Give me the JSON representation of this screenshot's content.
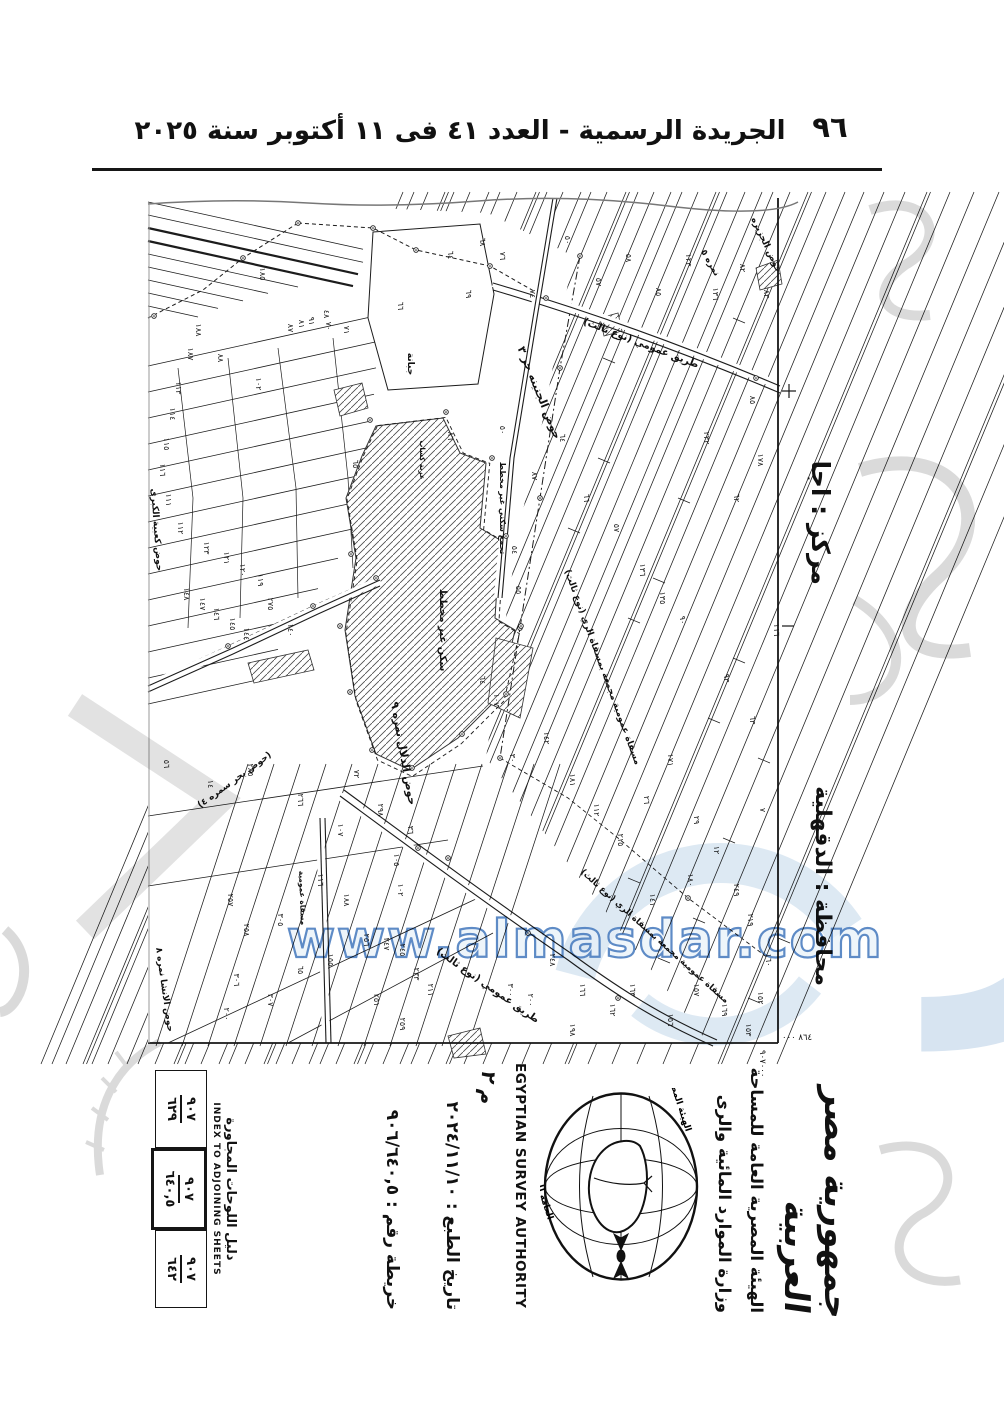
{
  "header": {
    "page_number": "٩٦",
    "title": "الجريدة الرسمية - العدد ٤١ فى ١١ أكتوبر سنة ٢٠٢٥"
  },
  "map": {
    "markaz_label": "مركز : اجا",
    "governorate_label": "محافظة : الدقهلية",
    "easting": "٨٦٤ ٠٠٠",
    "northing": "٩٠٧٠٠٠",
    "area_labels": [
      {
        "t": "حوض الجزيره",
        "x": 616,
        "y": 48,
        "r": 65,
        "s": 9
      },
      {
        "t": "نمره ٥",
        "x": 560,
        "y": 66,
        "r": 60,
        "s": 9
      },
      {
        "t": "طريق عمومي (نوع ثالث)",
        "x": 492,
        "y": 148,
        "r": 21,
        "s": 10
      },
      {
        "t": "حوض الجنينه حر ٣",
        "x": 388,
        "y": 196,
        "r": 68,
        "s": 11
      },
      {
        "t": "مسقاة عمومية مجمعة بمسقاة الري (نوع ثالث)",
        "x": 452,
        "y": 470,
        "r": 70,
        "s": 9
      },
      {
        "t": "حوض الدلال نمره ٩",
        "x": 252,
        "y": 556,
        "r": 80,
        "s": 11
      },
      {
        "t": "(حوض بحر سمره ٤)",
        "x": 88,
        "y": 584,
        "r": -36,
        "s": 9
      },
      {
        "t": "حوض كعبية الكبرى",
        "x": 6,
        "y": 332,
        "r": 86,
        "s": 9
      },
      {
        "t": "حوض الانشا نمره ٨",
        "x": 14,
        "y": 792,
        "r": 82,
        "s": 9
      },
      {
        "t": "جبانة",
        "x": 260,
        "y": 166,
        "r": 90,
        "s": 9
      },
      {
        "t": "سكن غير مخطط",
        "x": 292,
        "y": 432,
        "r": 90,
        "s": 10
      },
      {
        "t": "تجمع سكني غير مخطط",
        "x": 352,
        "y": 310,
        "r": 90,
        "s": 8
      },
      {
        "t": "عزبة كساب",
        "x": 272,
        "y": 262,
        "r": 90,
        "s": 7
      },
      {
        "t": "طريق عمومي (نوع ثالث)",
        "x": 338,
        "y": 790,
        "r": 35,
        "s": 10
      },
      {
        "t": "مسقاة عمومية مجمعة بمسقاة الري (نوع ثالث)",
        "x": 505,
        "y": 740,
        "r": 42,
        "s": 8.5
      },
      {
        "t": "مسقاة عمومية",
        "x": 152,
        "y": 700,
        "r": 88,
        "s": 7.5
      }
    ],
    "parcel_numbers": [
      {
        "t": "٦٤",
        "x": 300,
        "y": 57
      },
      {
        "t": "٦٨",
        "x": 332,
        "y": 44
      },
      {
        "t": "٦٩",
        "x": 318,
        "y": 96
      },
      {
        "t": "٧٦",
        "x": 352,
        "y": 58
      },
      {
        "t": "٧٤",
        "x": 382,
        "y": 96
      },
      {
        "t": "٥٠",
        "x": 417,
        "y": 42
      },
      {
        "t": "٥٧",
        "x": 448,
        "y": 84
      },
      {
        "t": "٥٨",
        "x": 478,
        "y": 60
      },
      {
        "t": "٨٥",
        "x": 508,
        "y": 94
      },
      {
        "t": "١٢٣",
        "x": 538,
        "y": 62
      },
      {
        "t": "١٣٦",
        "x": 565,
        "y": 96
      },
      {
        "t": "٨٢",
        "x": 592,
        "y": 70
      },
      {
        "t": "٨٣",
        "x": 616,
        "y": 96
      },
      {
        "t": "٥٠",
        "x": 352,
        "y": 232
      },
      {
        "t": "٨٧",
        "x": 384,
        "y": 278
      },
      {
        "t": "٦٤",
        "x": 412,
        "y": 240
      },
      {
        "t": "٦٦",
        "x": 436,
        "y": 300
      },
      {
        "t": "٥٧",
        "x": 466,
        "y": 330
      },
      {
        "t": "١٣٦",
        "x": 492,
        "y": 372
      },
      {
        "t": "١٣٥",
        "x": 512,
        "y": 400
      },
      {
        "t": "٩٠",
        "x": 532,
        "y": 422
      },
      {
        "t": "٦٢",
        "x": 586,
        "y": 300
      },
      {
        "t": "١٧٨",
        "x": 610,
        "y": 262
      },
      {
        "t": "٨٥",
        "x": 602,
        "y": 202
      },
      {
        "t": "١١٦",
        "x": 626,
        "y": 432
      },
      {
        "t": "٩٣",
        "x": 576,
        "y": 480
      },
      {
        "t": "٦٣",
        "x": 602,
        "y": 522
      },
      {
        "t": "٢٣٢",
        "x": 556,
        "y": 240
      },
      {
        "t": "١٠٧",
        "x": 346,
        "y": 502
      },
      {
        "t": "٣٠",
        "x": 362,
        "y": 560
      },
      {
        "t": "١٤٢",
        "x": 396,
        "y": 540
      },
      {
        "t": "١٨١",
        "x": 422,
        "y": 582
      },
      {
        "t": "١١٢",
        "x": 446,
        "y": 612
      },
      {
        "t": "٢١٥",
        "x": 470,
        "y": 642
      },
      {
        "t": "٢٦",
        "x": 496,
        "y": 602
      },
      {
        "t": "١٧١",
        "x": 520,
        "y": 562
      },
      {
        "t": "٢٩",
        "x": 546,
        "y": 622
      },
      {
        "t": "١٢",
        "x": 566,
        "y": 652
      },
      {
        "t": "١٨٠",
        "x": 540,
        "y": 682
      },
      {
        "t": "١٤١",
        "x": 502,
        "y": 702
      },
      {
        "t": "٢٤٩",
        "x": 586,
        "y": 692
      },
      {
        "t": "٢١٩",
        "x": 600,
        "y": 722
      },
      {
        "t": "٧",
        "x": 612,
        "y": 612
      },
      {
        "t": "١٦٠",
        "x": 618,
        "y": 762
      },
      {
        "t": "١٥٢",
        "x": 610,
        "y": 800
      },
      {
        "t": "١٥٣",
        "x": 598,
        "y": 832
      },
      {
        "t": "١٦٩",
        "x": 574,
        "y": 812
      },
      {
        "t": "١٥٧",
        "x": 546,
        "y": 792
      },
      {
        "t": "١٥٦",
        "x": 520,
        "y": 822
      },
      {
        "t": "١٦٣",
        "x": 482,
        "y": 792
      },
      {
        "t": "١٦٢",
        "x": 462,
        "y": 812
      },
      {
        "t": "١٦٦",
        "x": 432,
        "y": 792
      },
      {
        "t": "٢٤٨",
        "x": 402,
        "y": 762
      },
      {
        "t": "٢٠٠",
        "x": 380,
        "y": 802
      },
      {
        "t": "٣٠٠",
        "x": 360,
        "y": 792
      },
      {
        "t": "١٩٨",
        "x": 422,
        "y": 832
      },
      {
        "t": "٦٦",
        "x": 250,
        "y": 108
      },
      {
        "t": "١٨٥",
        "x": 112,
        "y": 76
      },
      {
        "t": "٤٨",
        "x": 176,
        "y": 116
      },
      {
        "t": "١٠٢",
        "x": 108,
        "y": 186
      },
      {
        "t": "٨٧",
        "x": 140,
        "y": 130
      },
      {
        "t": "٨١",
        "x": 151,
        "y": 126
      },
      {
        "t": "٩١",
        "x": 161,
        "y": 123
      },
      {
        "t": "٧٠",
        "x": 178,
        "y": 128
      },
      {
        "t": "٧١",
        "x": 196,
        "y": 132
      },
      {
        "t": "٨٨",
        "x": 70,
        "y": 160
      },
      {
        "t": "٦٥",
        "x": 205,
        "y": 266
      },
      {
        "t": "٨٦",
        "x": 300,
        "y": 238
      },
      {
        "t": "٥٤",
        "x": 364,
        "y": 352
      },
      {
        "t": "٥٥",
        "x": 368,
        "y": 392
      },
      {
        "t": "٦٤",
        "x": 332,
        "y": 482
      },
      {
        "t": "١٨٨",
        "x": 48,
        "y": 132
      },
      {
        "t": "١٨٧",
        "x": 40,
        "y": 156
      },
      {
        "t": "١١٣",
        "x": 28,
        "y": 190
      },
      {
        "t": "١١٤",
        "x": 22,
        "y": 216
      },
      {
        "t": "١١٥",
        "x": 16,
        "y": 246
      },
      {
        "t": "١١٦",
        "x": 12,
        "y": 272
      },
      {
        "t": "١١١",
        "x": 18,
        "y": 302
      },
      {
        "t": "١١٢",
        "x": 30,
        "y": 330
      },
      {
        "t": "١٢٣",
        "x": 56,
        "y": 350
      },
      {
        "t": "١٢١",
        "x": 76,
        "y": 360
      },
      {
        "t": "١٢٠",
        "x": 92,
        "y": 372
      },
      {
        "t": "١١٩",
        "x": 110,
        "y": 382
      },
      {
        "t": "١٤٨",
        "x": 36,
        "y": 396
      },
      {
        "t": "١٤٧",
        "x": 52,
        "y": 406
      },
      {
        "t": "١٤٦",
        "x": 66,
        "y": 416
      },
      {
        "t": "١٤٥",
        "x": 82,
        "y": 426
      },
      {
        "t": "١٤٤",
        "x": 96,
        "y": 436
      },
      {
        "t": "٢٧٥",
        "x": 120,
        "y": 406
      },
      {
        "t": "١٤٠",
        "x": 140,
        "y": 432
      },
      {
        "t": "٥٦",
        "x": 16,
        "y": 566
      },
      {
        "t": "١٤",
        "x": 60,
        "y": 586
      },
      {
        "t": "٢٨٥",
        "x": 100,
        "y": 572
      },
      {
        "t": "٢٦٦",
        "x": 150,
        "y": 602
      },
      {
        "t": "٢٩٨",
        "x": 230,
        "y": 612
      },
      {
        "t": "١٠٧",
        "x": 190,
        "y": 632
      },
      {
        "t": "٧٢",
        "x": 206,
        "y": 576
      },
      {
        "t": "١١٦",
        "x": 170,
        "y": 682
      },
      {
        "t": "١٠٥",
        "x": 246,
        "y": 662
      },
      {
        "t": "١٠٢",
        "x": 250,
        "y": 692
      },
      {
        "t": "٣٦",
        "x": 260,
        "y": 632
      },
      {
        "t": "٢٥٧",
        "x": 80,
        "y": 702
      },
      {
        "t": "٢٥٨",
        "x": 96,
        "y": 732
      },
      {
        "t": "٣٠٥",
        "x": 130,
        "y": 722
      },
      {
        "t": "٣٠٦",
        "x": 86,
        "y": 782
      },
      {
        "t": "٣٠٧",
        "x": 120,
        "y": 802
      },
      {
        "t": "٢٠٠",
        "x": 76,
        "y": 816
      },
      {
        "t": "١٨٨",
        "x": 196,
        "y": 702
      },
      {
        "t": "٢٥٦",
        "x": 216,
        "y": 742
      },
      {
        "t": "٢٤٧",
        "x": 236,
        "y": 746
      },
      {
        "t": "٢٤٥",
        "x": 252,
        "y": 752
      },
      {
        "t": "٢٣٣",
        "x": 266,
        "y": 776
      },
      {
        "t": "٢١١",
        "x": 280,
        "y": 792
      },
      {
        "t": "٢٥١",
        "x": 226,
        "y": 802
      },
      {
        "t": "٢٥٩",
        "x": 252,
        "y": 826
      },
      {
        "t": "١٥٥",
        "x": 180,
        "y": 762
      },
      {
        "t": "٦٥",
        "x": 150,
        "y": 772
      }
    ]
  },
  "footer": {
    "index_title_ar": "دليل اللوحات المجاورة",
    "index_title_en": "INDEX TO ADJOINING SHEETS",
    "index_cells": [
      {
        "num": "٩٠٧",
        "den": "٦٢٩",
        "current": false
      },
      {
        "num": "٩٠٧",
        "den": "٦٤٠,٥",
        "current": true
      },
      {
        "num": "٩٠٧",
        "den": "٦٤٢",
        "current": false
      }
    ],
    "map_number": "خريطة رقم : ٩٠٦/٦٤٠,٥",
    "print_date": "تاريخ الطبع : ٢٠٢٤/١١/١٠",
    "annotation": "م ٢",
    "authority_en": "EGYPTIAN SURVEY AUTHORITY",
    "ministry_ar": "وزارة الموارد المائية والرى",
    "authority_ar": "الهيئة المصرية العامة للمساحة",
    "country_ar": "جمهورية مصر العربية",
    "emblem_caption_top": "الهيئة المصرية",
    "emblem_caption_bottom": "العامة للمساحة"
  },
  "watermark": {
    "brand": "المصدر",
    "url": "www.almasdar.com",
    "brand_color": "#b7cee5",
    "url_color": "#4d7fc0",
    "gray_color": "#c2c2c2"
  }
}
